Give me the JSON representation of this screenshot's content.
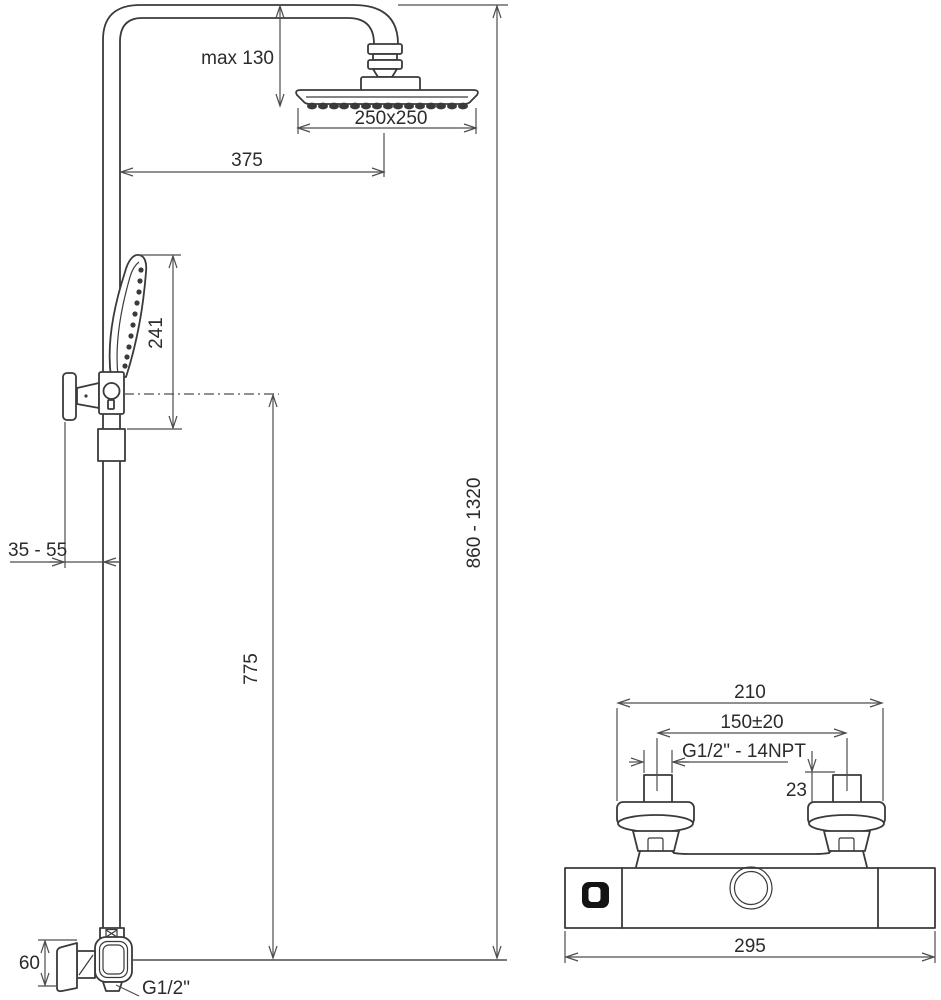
{
  "colors": {
    "background": "#ffffff",
    "outline": "#3a3a3a",
    "dimension_line": "#4d4d4d",
    "label_text": "#2b2b2b",
    "button_fill": "#141414"
  },
  "column": {
    "labels": {
      "head_max_drop": "max 130",
      "head_size": "250x250",
      "head_offset": "375",
      "hand_shower_length": "241",
      "total_height_range": "860 - 1320",
      "holder_height": "775",
      "wall_clearance": "35 - 55",
      "bottom_elbow_height": "60",
      "bottom_thread": "G1/2\""
    }
  },
  "mixer": {
    "labels": {
      "flange_span": "210",
      "inlet_spacing": "150±20",
      "inlet_thread": "G1/2\" - 14NPT",
      "inlet_neck_height": "23",
      "body_width": "295"
    }
  }
}
